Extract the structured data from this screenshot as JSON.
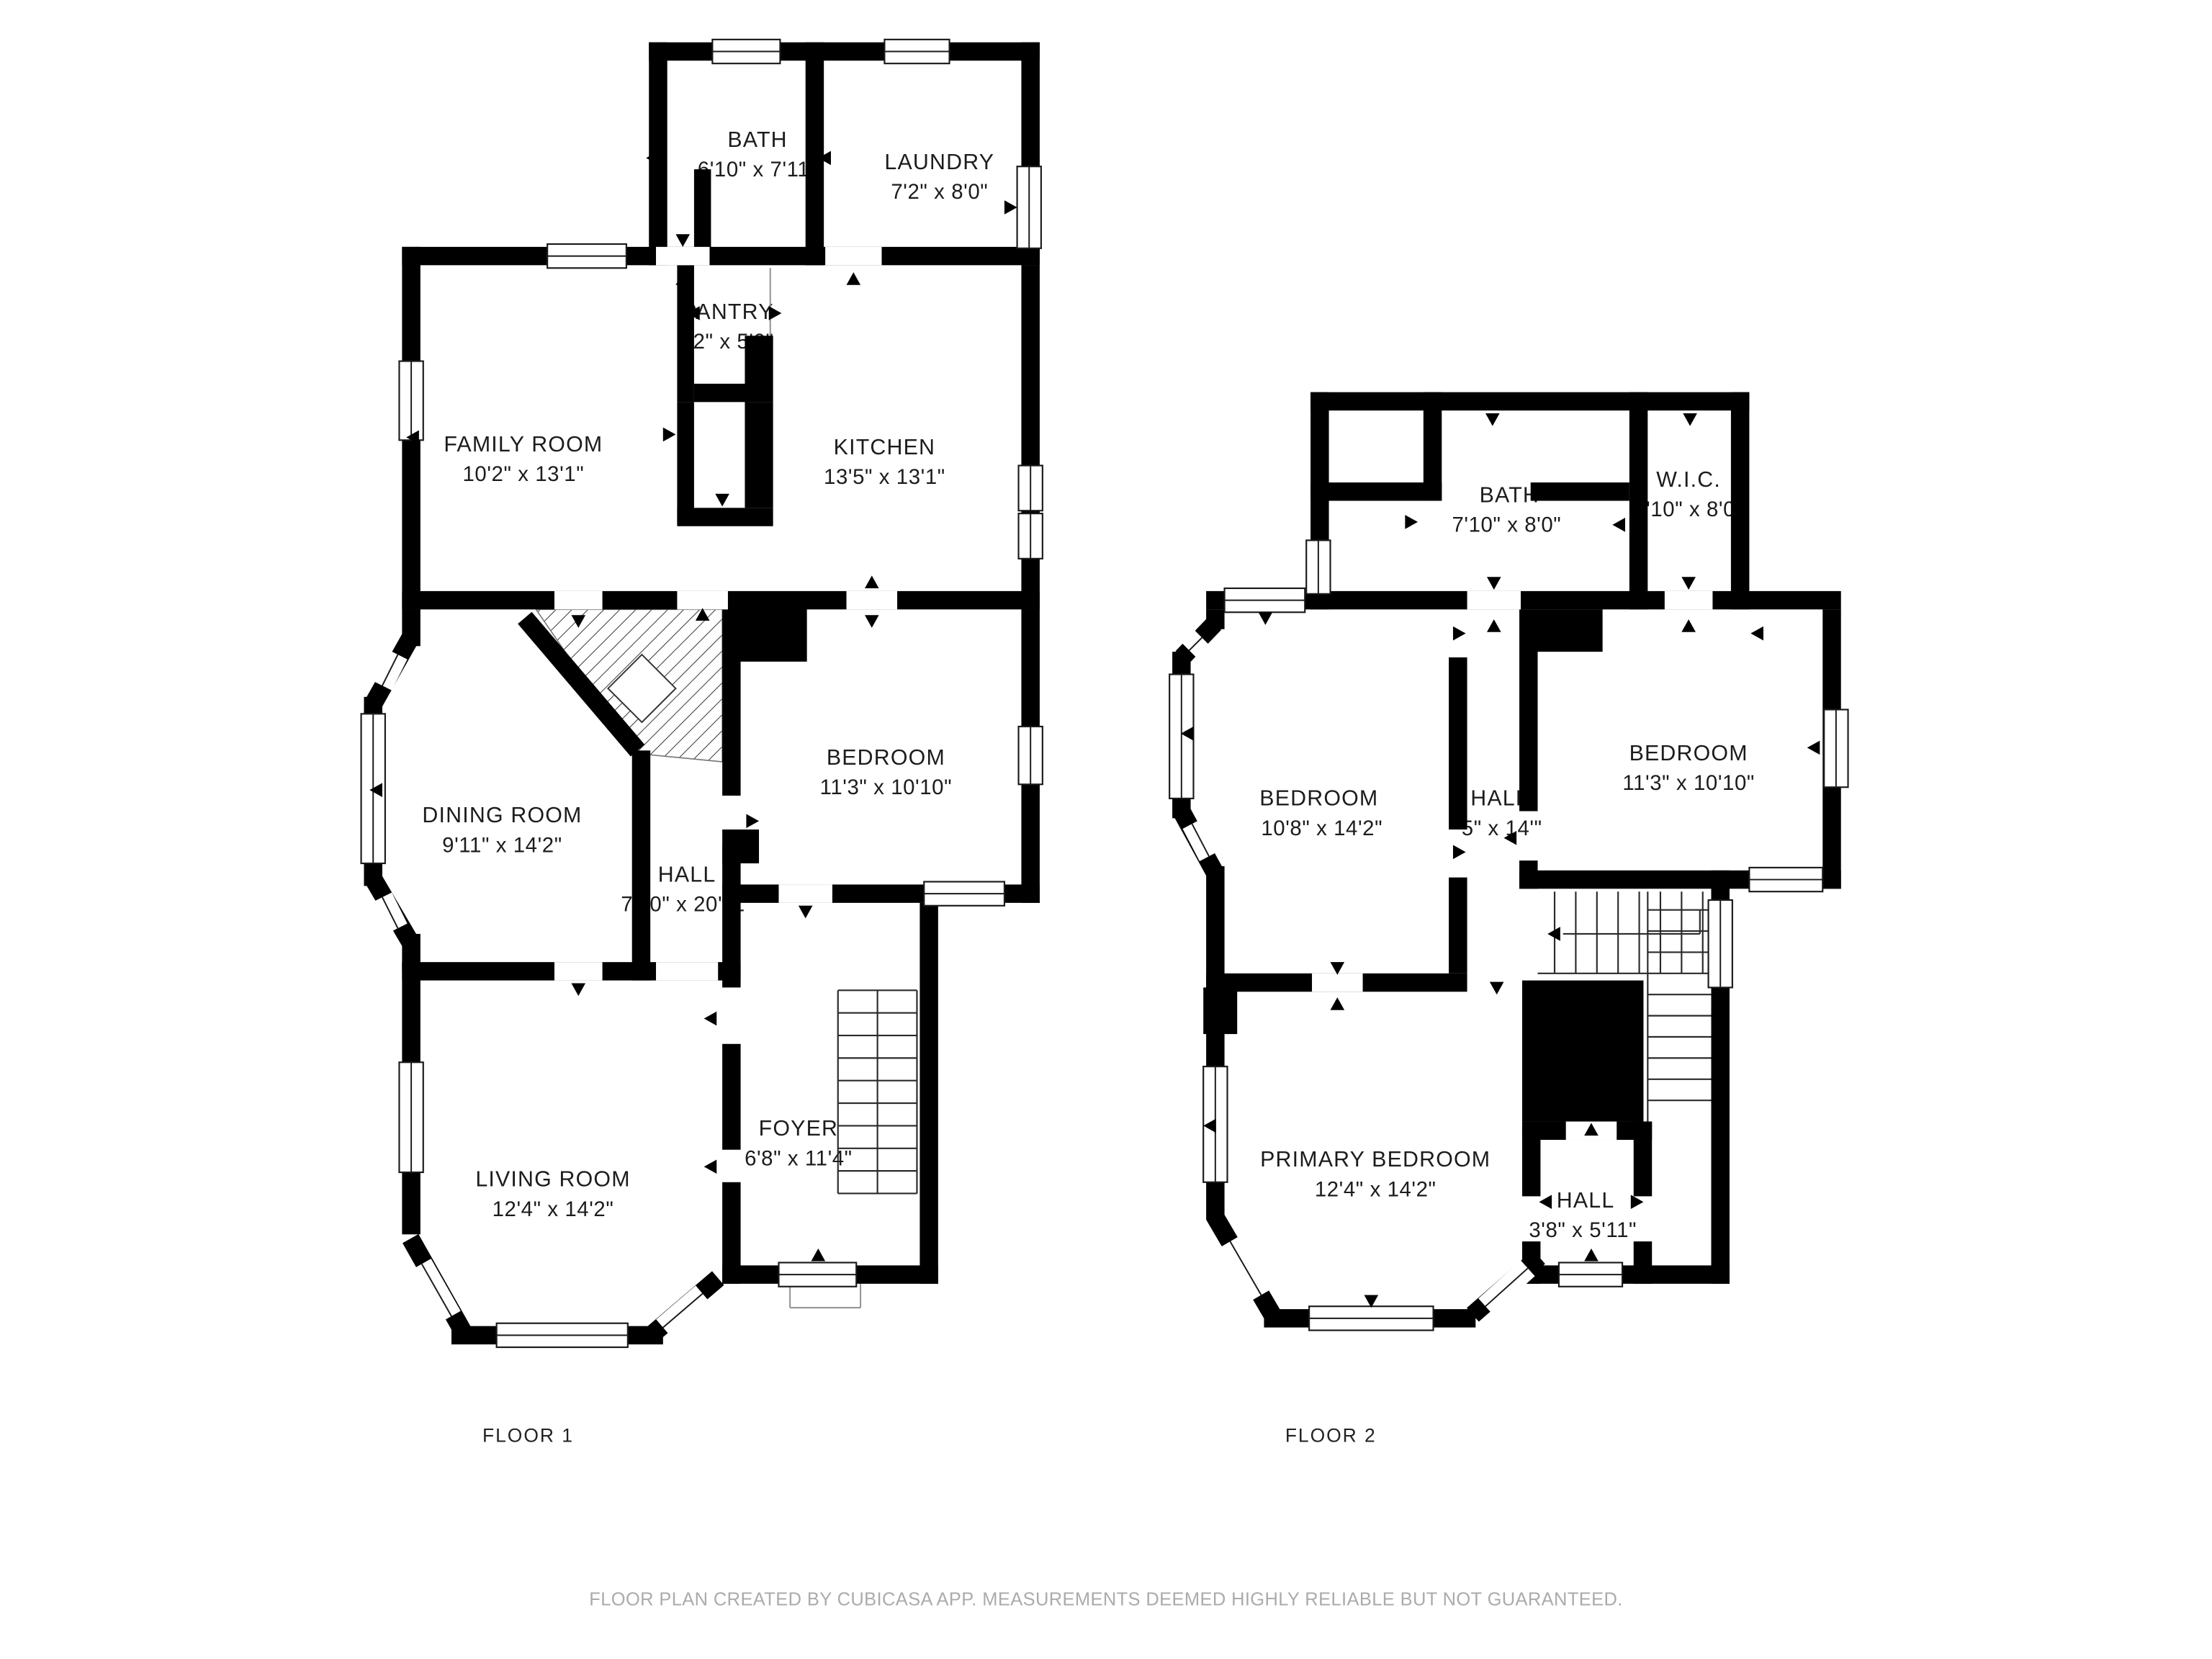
{
  "page": {
    "background": "#ffffff",
    "wall_color": "#000000",
    "room_color": "#ffffff",
    "label_color": "#1c1c1c",
    "footer_color": "#ababab"
  },
  "footer": {
    "text": "FLOOR PLAN CREATED BY CUBICASA APP. MEASUREMENTS DEEMED HIGHLY RELIABLE BUT NOT GUARANTEED."
  },
  "floor1": {
    "caption": "FLOOR 1",
    "rooms": {
      "bath": {
        "name": "BATH",
        "dims": "6'10\" x 7'11\""
      },
      "laundry": {
        "name": "LAUNDRY",
        "dims": "7'2\" x 8'0\""
      },
      "pantry": {
        "name": "PANTRY",
        "dims": "3'2\" x 5'0\""
      },
      "family": {
        "name": "FAMILY ROOM",
        "dims": "10'2\" x 13'1\""
      },
      "kitchen": {
        "name": "KITCHEN",
        "dims": "13'5\" x 13'1\""
      },
      "dining": {
        "name": "DINING ROOM",
        "dims": "9'11\" x 14'2\""
      },
      "bedroom": {
        "name": "BEDROOM",
        "dims": "11'3\" x 10'10\""
      },
      "hall": {
        "name": "HALL",
        "dims": "7'10\" x 20'11\""
      },
      "foyer": {
        "name": "FOYER",
        "dims": "6'8\" x 11'4\""
      },
      "living": {
        "name": "LIVING ROOM",
        "dims": "12'4\" x 14'2\""
      }
    }
  },
  "floor2": {
    "caption": "FLOOR 2",
    "rooms": {
      "bath": {
        "name": "BATH",
        "dims": "7'10\" x 8'0\""
      },
      "wic": {
        "name": "W.I.C.",
        "dims": "3'10\" x 8'0\""
      },
      "bedroom_left": {
        "name": "BEDROOM",
        "dims": "10'8\" x 14'2\""
      },
      "hall": {
        "name": "HALL",
        "dims": "'5\" x 14'\""
      },
      "bedroom_right": {
        "name": "BEDROOM",
        "dims": "11'3\" x 10'10\""
      },
      "primary": {
        "name": "PRIMARY BEDROOM",
        "dims": "12'4\" x 14'2\""
      },
      "hall_small": {
        "name": "HALL",
        "dims": "3'8\" x 5'11\""
      }
    }
  }
}
